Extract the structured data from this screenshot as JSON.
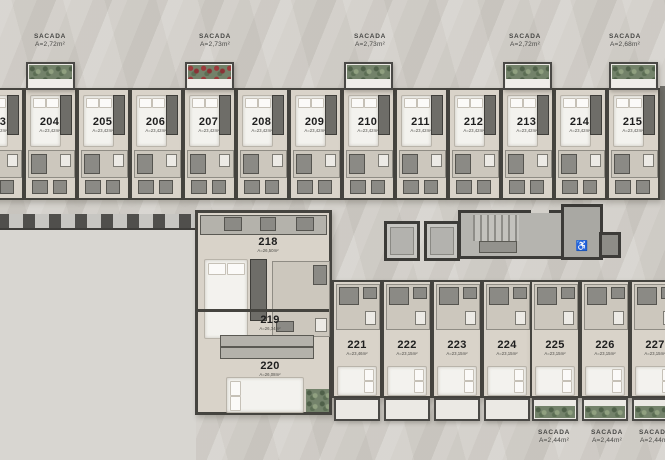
{
  "plan_title": "floor-plan-level-2",
  "balconies_top": [
    {
      "label": "SACADA",
      "area": "A=2,72m²"
    },
    {
      "label": "SACADA",
      "area": "A=2,73m²"
    },
    {
      "label": "SACADA",
      "area": "A=2,73m²"
    },
    {
      "label": "SACADA",
      "area": "A=2,72m²"
    },
    {
      "label": "SACADA",
      "area": "A=2,68m²"
    }
  ],
  "balconies_bottom": [
    {
      "label": "SACADA",
      "area": "A=2,44m²"
    },
    {
      "label": "SACADA",
      "area": "A=2,44m²"
    },
    {
      "label": "SACADA",
      "area": "A=2,44m²"
    }
  ],
  "top_units": [
    {
      "number": "203",
      "area": "A=23,42m²"
    },
    {
      "number": "204",
      "area": "A=23,42m²"
    },
    {
      "number": "205",
      "area": "A=23,42m²"
    },
    {
      "number": "206",
      "area": "A=23,42m²"
    },
    {
      "number": "207",
      "area": "A=23,42m²"
    },
    {
      "number": "208",
      "area": "A=23,42m²"
    },
    {
      "number": "209",
      "area": "A=23,42m²"
    },
    {
      "number": "210",
      "area": "A=23,42m²"
    },
    {
      "number": "211",
      "area": "A=23,42m²"
    },
    {
      "number": "212",
      "area": "A=23,42m²"
    },
    {
      "number": "213",
      "area": "A=23,42m²"
    },
    {
      "number": "214",
      "area": "A=23,42m²"
    },
    {
      "number": "215",
      "area": "A=23,42m²"
    }
  ],
  "middle_units": [
    {
      "number": "218",
      "area": "A=26,50m²"
    },
    {
      "number": "219",
      "area": "A=26,34m²"
    },
    {
      "number": "220",
      "area": "A=26,08m²"
    }
  ],
  "bottom_units": [
    {
      "number": "221",
      "area": "A=23,46m²"
    },
    {
      "number": "222",
      "area": "A=23,15m²"
    },
    {
      "number": "223",
      "area": "A=23,15m²"
    },
    {
      "number": "224",
      "area": "A=23,15m²"
    },
    {
      "number": "225",
      "area": "A=23,15m²"
    },
    {
      "number": "226",
      "area": "A=23,15m²"
    },
    {
      "number": "227",
      "area": "A=23,15m²"
    }
  ]
}
